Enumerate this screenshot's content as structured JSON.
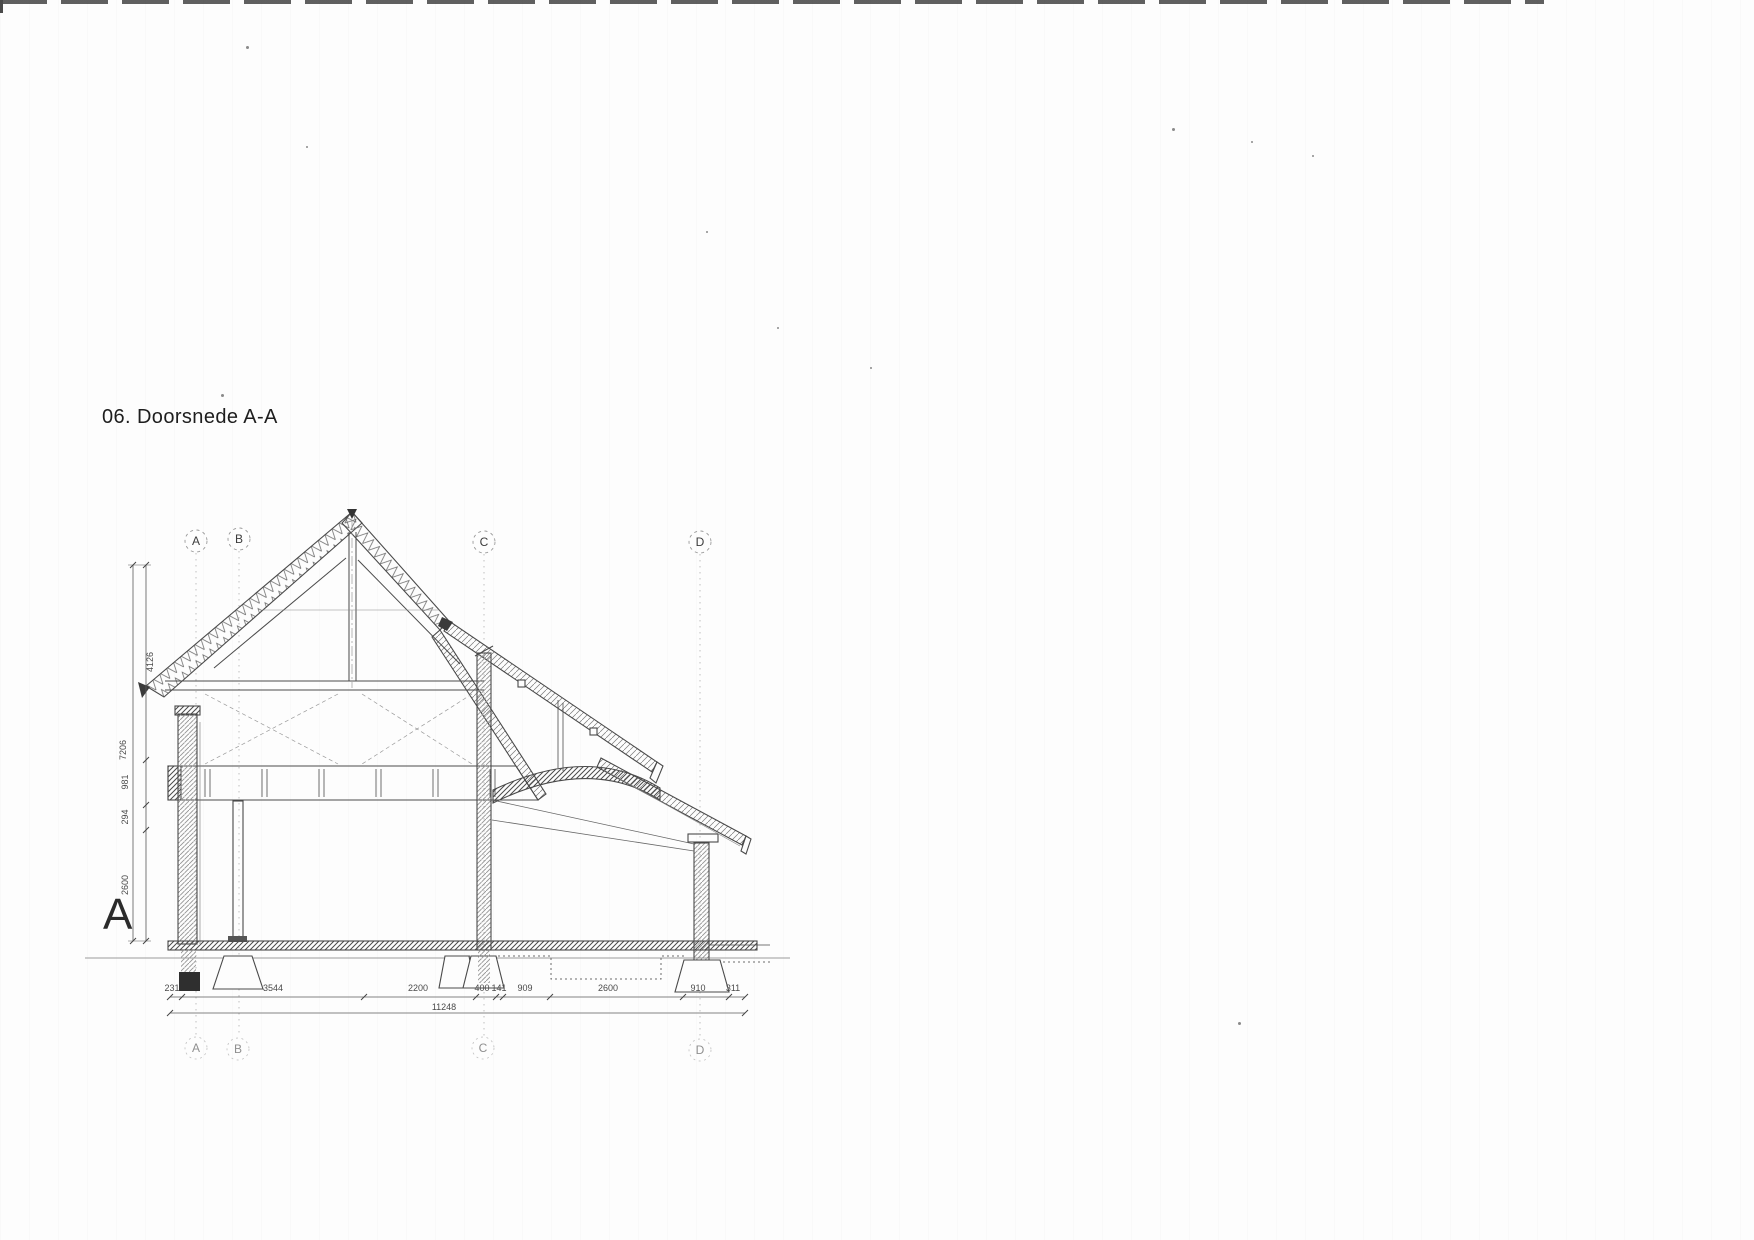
{
  "title": "06. Doorsnede A-A",
  "section": {
    "cut_label": "A"
  },
  "grid": {
    "letters": [
      "A",
      "B",
      "C",
      "D"
    ]
  },
  "dimensions": {
    "bottom": {
      "segments": [
        "231",
        "3544",
        "2200",
        "400",
        "141",
        "909",
        "2600",
        "910",
        "311"
      ],
      "total": "11248"
    },
    "left": {
      "overall": "7206",
      "segments": [
        "4126",
        "981",
        "294",
        "2600"
      ]
    }
  }
}
